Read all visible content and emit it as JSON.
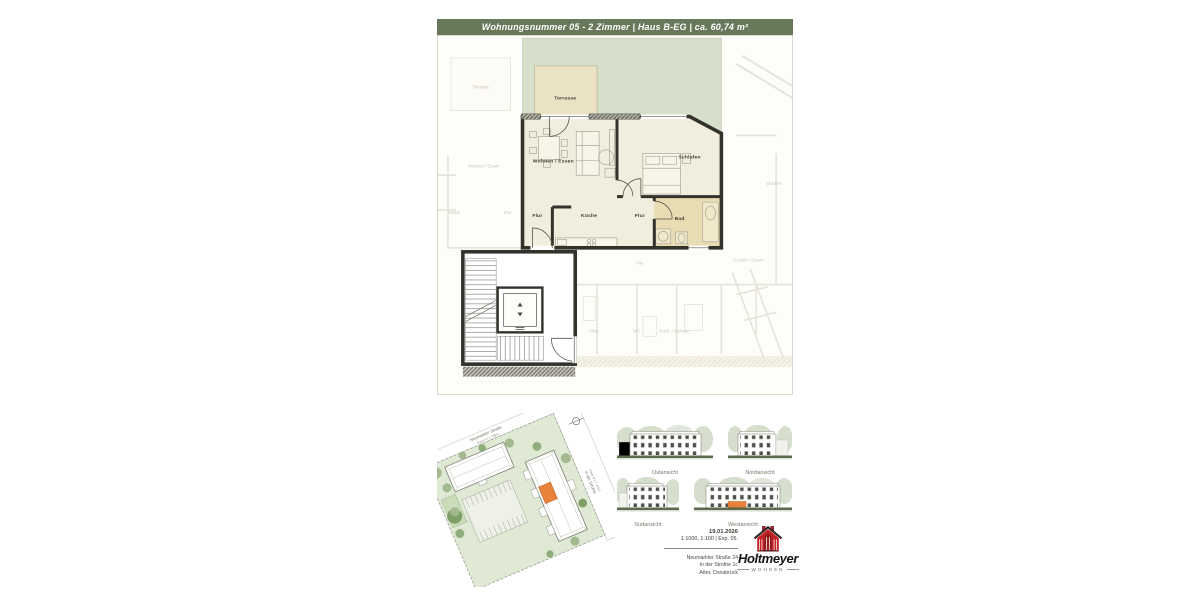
{
  "header": {
    "title": "Wohnungsnummer 05 - 2 Zimmer | Haus B-EG | ca. 60,74 m²"
  },
  "floorplan": {
    "rooms": {
      "terrace": "Terrasse",
      "living": "Wohnen / Essen",
      "hall_entry": "Flur",
      "kitchen": "Küche",
      "hall_center": "Flur",
      "sleeping": "Schlafen",
      "bath": "Bad"
    },
    "faded_labels": {
      "terrace_left": "Terrasse",
      "living_left": "Wohnen / Essen",
      "kitchen_left": "Küche",
      "hall_left": "Flur",
      "living_right": "Wohnen",
      "hall_bottom": "Flur",
      "cook_eat_bottom": "Kochen / Essen",
      "storage_bottom": "Abst.",
      "wc_bottom": "WC",
      "cook_live_bottom": "Koch. / Wohnen"
    }
  },
  "siteplan": {
    "road_top": "Neumarkter Straße",
    "road_top_sub": "Haus A | 1. WEG",
    "road_right": "In der Strothe",
    "road_right_sub": "Haus B | 2. WEG"
  },
  "elevations": {
    "east": "Ostansicht",
    "north": "Nordansicht",
    "south": "Südansicht",
    "west": "Westansicht"
  },
  "titleblock": {
    "date": "19.01.2026",
    "scale": "1:1000, 1:100 | Exp. 05.",
    "address1": "Neumarkter Straße 24",
    "address2": "In der Strothe 1c",
    "address3": "Atter, Osnabrück"
  },
  "logo": {
    "name": "Holtmeyer",
    "tagline": "WOHNEN"
  },
  "colors": {
    "header_green": "#67795a",
    "garden_green": "#d5dfca",
    "floor_ivory": "#f2eedd",
    "terrace_beige": "#ebe2c3",
    "bath_beige": "#e7dcb2",
    "wall_dark": "#33332c",
    "accent_orange": "#e8813a",
    "logo_red": "#c22127"
  }
}
